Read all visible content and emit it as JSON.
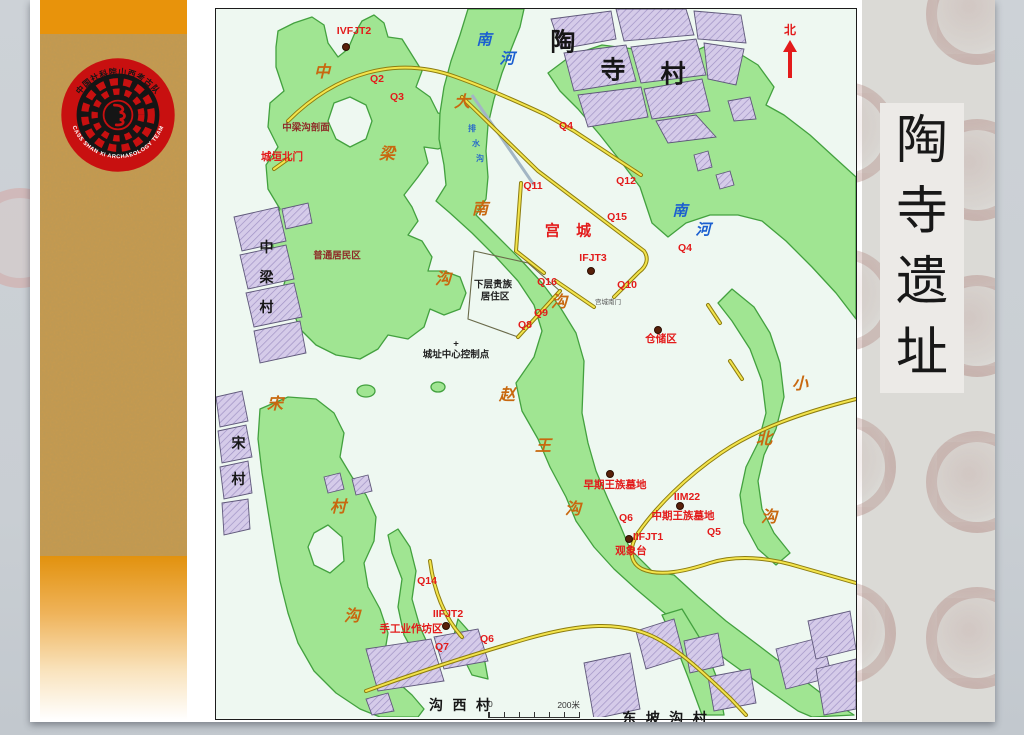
{
  "slide_title": {
    "chars": [
      "陶",
      "寺",
      "遗",
      "址"
    ]
  },
  "logo": {
    "ring_top": "中国社科院山西考古队",
    "ring_bottom": "CASS SHAN XI ARCHAEOLOGY TEAM"
  },
  "map": {
    "north_label": "北",
    "scale": {
      "left": "0",
      "right": "200米"
    },
    "labels": [
      {
        "t": "陶",
        "x": 348,
        "y": 34,
        "c": "lv"
      },
      {
        "t": "寺",
        "x": 398,
        "y": 62,
        "c": "lv"
      },
      {
        "t": "村",
        "x": 458,
        "y": 66,
        "c": "lv"
      },
      {
        "t": "中",
        "x": 52,
        "y": 240,
        "c": "vil"
      },
      {
        "t": "梁",
        "x": 52,
        "y": 270,
        "c": "vil"
      },
      {
        "t": "村",
        "x": 52,
        "y": 300,
        "c": "vil"
      },
      {
        "t": "宋",
        "x": 24,
        "y": 436,
        "c": "vil"
      },
      {
        "t": "村",
        "x": 24,
        "y": 472,
        "c": "vil"
      },
      {
        "t": "沟 西 村",
        "x": 245,
        "y": 698,
        "c": "vil"
      },
      {
        "t": "东 坡 沟 村",
        "x": 450,
        "y": 711,
        "c": "vil"
      },
      {
        "t": "南",
        "x": 268,
        "y": 32,
        "c": "riv"
      },
      {
        "t": "河",
        "x": 291,
        "y": 51,
        "c": "riv"
      },
      {
        "t": "南",
        "x": 464,
        "y": 203,
        "c": "riv"
      },
      {
        "t": "河",
        "x": 487,
        "y": 222,
        "c": "riv"
      },
      {
        "t": "排",
        "x": 256,
        "y": 120,
        "c": "tb"
      },
      {
        "t": "水",
        "x": 260,
        "y": 135,
        "c": "tb"
      },
      {
        "t": "沟",
        "x": 264,
        "y": 150,
        "c": "tb"
      },
      {
        "t": "中",
        "x": 106,
        "y": 64,
        "c": "gul"
      },
      {
        "t": "梁",
        "x": 171,
        "y": 146,
        "c": "gul"
      },
      {
        "t": "沟",
        "x": 227,
        "y": 271,
        "c": "gul"
      },
      {
        "t": "大",
        "x": 246,
        "y": 94,
        "c": "gul"
      },
      {
        "t": "南",
        "x": 264,
        "y": 201,
        "c": "gul"
      },
      {
        "t": "沟",
        "x": 343,
        "y": 294,
        "c": "gul"
      },
      {
        "t": "赵",
        "x": 291,
        "y": 387,
        "c": "gul"
      },
      {
        "t": "王",
        "x": 327,
        "y": 438,
        "c": "gul"
      },
      {
        "t": "沟",
        "x": 357,
        "y": 501,
        "c": "gul"
      },
      {
        "t": "小",
        "x": 584,
        "y": 376,
        "c": "gul"
      },
      {
        "t": "北",
        "x": 548,
        "y": 431,
        "c": "gul"
      },
      {
        "t": "沟",
        "x": 553,
        "y": 509,
        "c": "gul"
      },
      {
        "t": "宋",
        "x": 59,
        "y": 396,
        "c": "gul"
      },
      {
        "t": "村",
        "x": 122,
        "y": 499,
        "c": "gul"
      },
      {
        "t": "沟",
        "x": 136,
        "y": 608,
        "c": "gul"
      },
      {
        "t": "宫 城",
        "x": 355,
        "y": 222,
        "c": "redlg"
      },
      {
        "t": "IVFJT2",
        "x": 138,
        "y": 22,
        "c": "red"
      },
      {
        "t": "Q2",
        "x": 161,
        "y": 70,
        "c": "red"
      },
      {
        "t": "Q3",
        "x": 181,
        "y": 88,
        "c": "red"
      },
      {
        "t": "Q4",
        "x": 350,
        "y": 117,
        "c": "red"
      },
      {
        "t": "Q11",
        "x": 317,
        "y": 177,
        "c": "red"
      },
      {
        "t": "Q12",
        "x": 410,
        "y": 172,
        "c": "red"
      },
      {
        "t": "Q15",
        "x": 401,
        "y": 208,
        "c": "red"
      },
      {
        "t": "Q4",
        "x": 469,
        "y": 239,
        "c": "red"
      },
      {
        "t": "IFJT3",
        "x": 377,
        "y": 249,
        "c": "red"
      },
      {
        "t": "Q10",
        "x": 411,
        "y": 276,
        "c": "red"
      },
      {
        "t": "Q16",
        "x": 331,
        "y": 273,
        "c": "red"
      },
      {
        "t": "Q9",
        "x": 325,
        "y": 304,
        "c": "red"
      },
      {
        "t": "Q8",
        "x": 309,
        "y": 316,
        "c": "red"
      },
      {
        "t": "仓储区",
        "x": 445,
        "y": 330,
        "c": "red"
      },
      {
        "t": "早期王族墓地",
        "x": 399,
        "y": 476,
        "c": "red"
      },
      {
        "t": "IIM22",
        "x": 471,
        "y": 488,
        "c": "red"
      },
      {
        "t": "中期王族墓地",
        "x": 467,
        "y": 507,
        "c": "red"
      },
      {
        "t": "Q6",
        "x": 410,
        "y": 509,
        "c": "red"
      },
      {
        "t": "Q5",
        "x": 498,
        "y": 523,
        "c": "red"
      },
      {
        "t": "IIFJT1",
        "x": 432,
        "y": 528,
        "c": "red"
      },
      {
        "t": "观象台",
        "x": 415,
        "y": 542,
        "c": "red"
      },
      {
        "t": "Q14",
        "x": 211,
        "y": 572,
        "c": "red"
      },
      {
        "t": "IIFJT2",
        "x": 232,
        "y": 605,
        "c": "red"
      },
      {
        "t": "手工业作坊区",
        "x": 195,
        "y": 620,
        "c": "red"
      },
      {
        "t": "Q6",
        "x": 271,
        "y": 630,
        "c": "red"
      },
      {
        "t": "Q7",
        "x": 226,
        "y": 638,
        "c": "red"
      },
      {
        "t": "城垣北门",
        "x": 66,
        "y": 148,
        "c": "red"
      },
      {
        "t": "中梁沟剖面",
        "x": 90,
        "y": 119,
        "c": "dred"
      },
      {
        "t": "普通居民区",
        "x": 121,
        "y": 247,
        "c": "dred"
      },
      {
        "t": "下层贵族",
        "x": 277,
        "y": 276,
        "c": "blk"
      },
      {
        "t": "居住区",
        "x": 279,
        "y": 288,
        "c": "blk"
      },
      {
        "t": "+",
        "x": 240,
        "y": 335,
        "c": "blk"
      },
      {
        "t": "城址中心控制点",
        "x": 240,
        "y": 346,
        "c": "blk"
      },
      {
        "t": "宫城南门",
        "x": 392,
        "y": 294,
        "c": "tiny"
      }
    ],
    "dots": [
      {
        "x": 130,
        "y": 38
      },
      {
        "x": 375,
        "y": 262
      },
      {
        "x": 442,
        "y": 321
      },
      {
        "x": 394,
        "y": 465
      },
      {
        "x": 464,
        "y": 497
      },
      {
        "x": 413,
        "y": 530
      },
      {
        "x": 230,
        "y": 617
      }
    ]
  },
  "colors": {
    "gully_green": "#a0e592",
    "gully_edge": "#43a13f",
    "village_purple": "#d5cbe9",
    "wall_yellow": "#f3e44c",
    "red_label": "#e31b1b",
    "gully_text": "#c8680f",
    "river_text": "#1b5fd0",
    "sidebar_orange": "#e8930b"
  }
}
